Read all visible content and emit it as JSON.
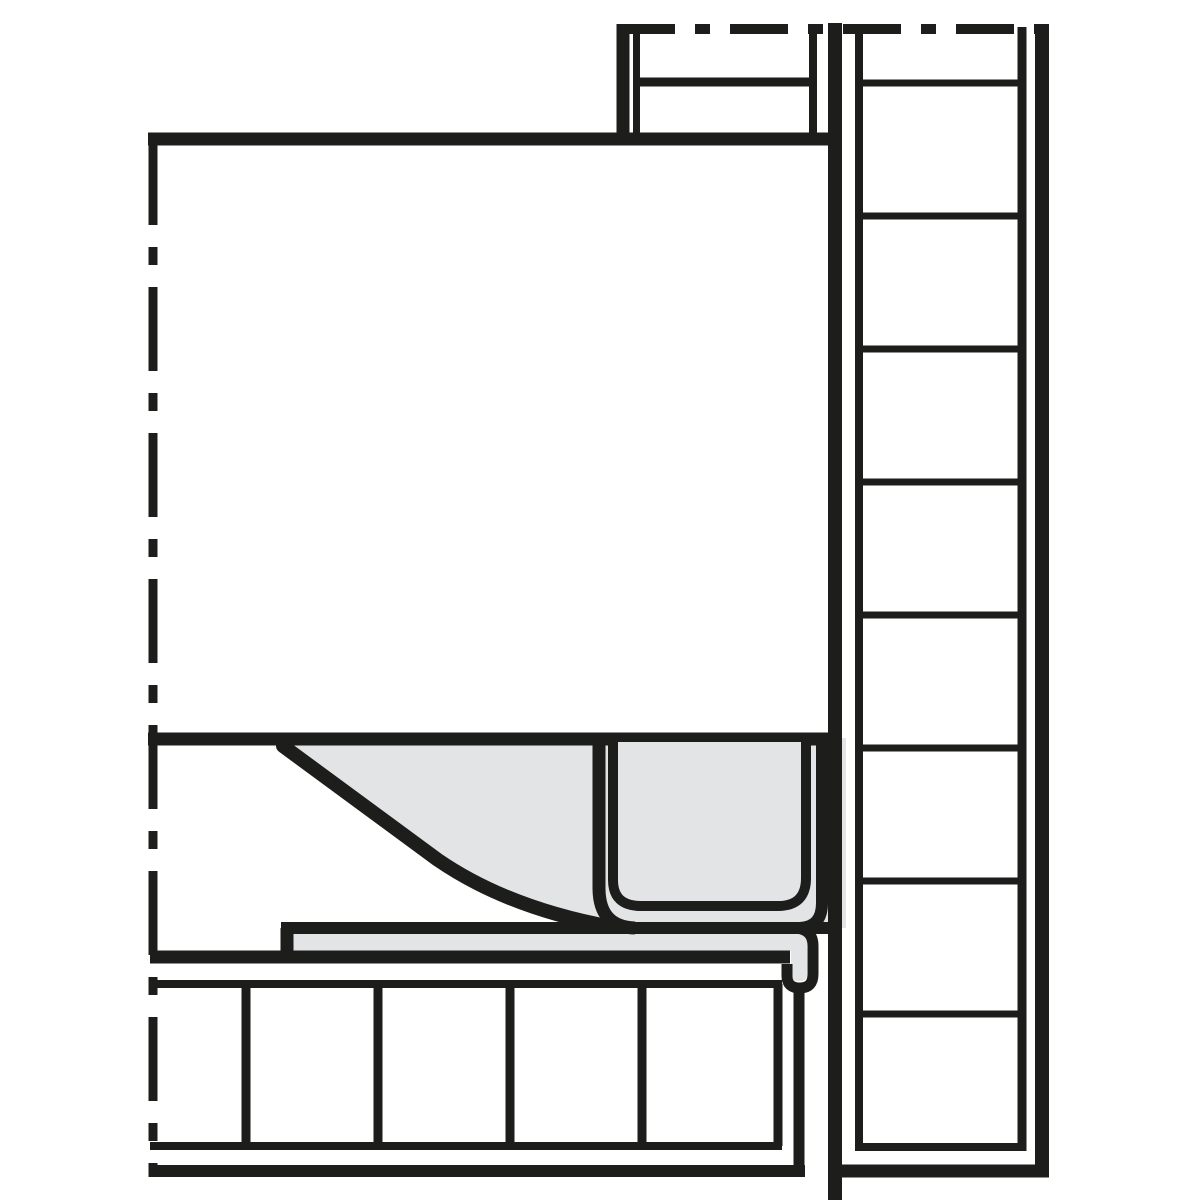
{
  "colors": {
    "background": "#ffffff",
    "ink": "#1d1d1b",
    "panel_gray": "#e3e4e6"
  },
  "figure": {
    "kind": "technical cross-section line drawing",
    "text_content": "none"
  }
}
